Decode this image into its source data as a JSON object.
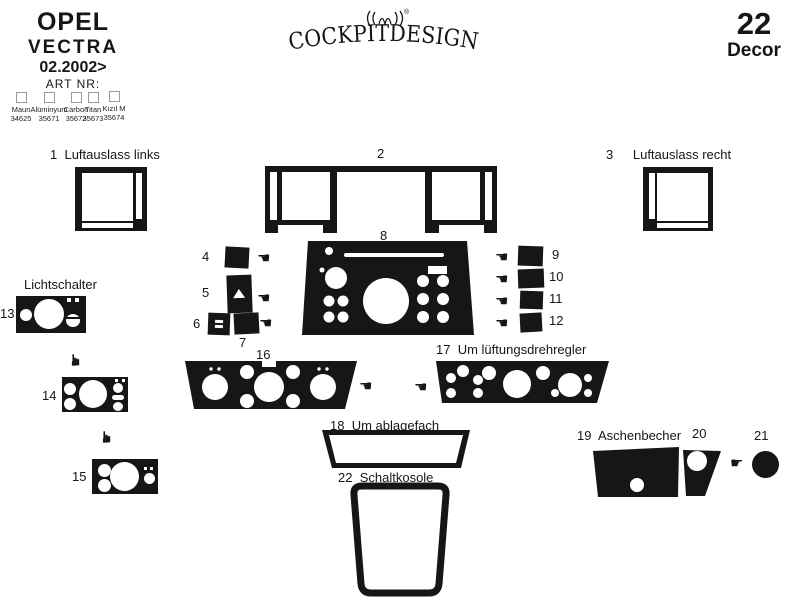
{
  "colors": {
    "ink": "#161616",
    "paper": "#ffffff",
    "checkbox_border": "#9a9a9a"
  },
  "header": {
    "brand": {
      "make": "OPEL",
      "model": "VECTRA",
      "year": "02.2002>",
      "art_label": "ART NR:"
    },
    "finish_options": [
      {
        "name": "Maun",
        "number": "34625"
      },
      {
        "name": "Alüminyum",
        "number": "35671"
      },
      {
        "name": "Carbon",
        "number": "35672"
      },
      {
        "name": "Titan",
        "number": "35673"
      },
      {
        "name": "Kızıl M",
        "number": "35674"
      }
    ],
    "logo": {
      "text": "COCKPITDESIGN",
      "registered": "®"
    },
    "decor": {
      "count": "22",
      "label": "Decor"
    }
  },
  "icons": {
    "hand_left": "☚",
    "hand_right": "☛",
    "hand_up_glyph": "☛"
  },
  "parts": {
    "p1": {
      "num": "1",
      "label": "Luftauslass links"
    },
    "p2": {
      "num": "2"
    },
    "p3": {
      "num": "3",
      "label": "Luftauslass recht"
    },
    "p4": {
      "num": "4"
    },
    "p5": {
      "num": "5"
    },
    "p6": {
      "num": "6"
    },
    "p7": {
      "num": "7"
    },
    "p8": {
      "num": "8"
    },
    "p9": {
      "num": "9"
    },
    "p10": {
      "num": "10"
    },
    "p11": {
      "num": "11"
    },
    "p12": {
      "num": "12"
    },
    "p13": {
      "num": "13",
      "label": "Lichtschalter"
    },
    "p14": {
      "num": "14"
    },
    "p15": {
      "num": "15"
    },
    "p16": {
      "num": "16"
    },
    "p17": {
      "num": "17",
      "label": "Um lüftungsdrehregler"
    },
    "p18": {
      "num": "18",
      "label": "Um ablagefach"
    },
    "p19": {
      "num": "19",
      "label": "Aschenbecher"
    },
    "p20": {
      "num": "20"
    },
    "p21": {
      "num": "21"
    },
    "p22": {
      "num": "22",
      "label": "Schaltkosole"
    }
  }
}
